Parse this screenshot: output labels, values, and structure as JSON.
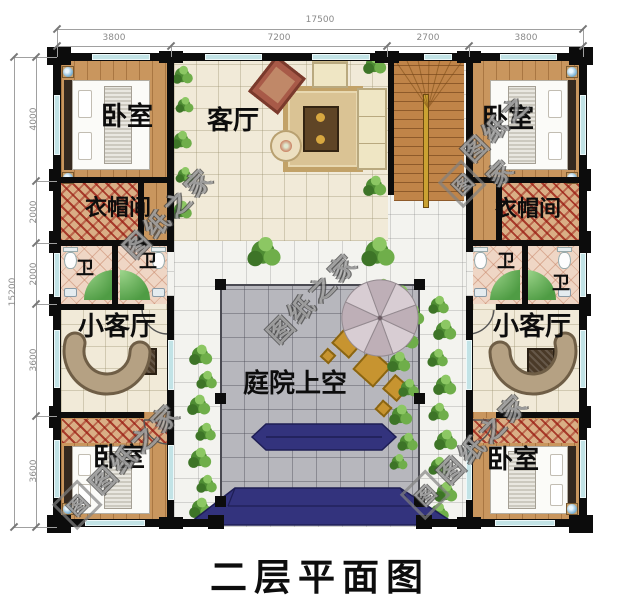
{
  "title": "二层平面图",
  "watermark": {
    "text": "图纸之家",
    "logo": "图"
  },
  "dims": {
    "top": {
      "total": "17500",
      "segs": [
        "3800",
        "7200",
        "2700",
        "3800"
      ]
    },
    "left": {
      "total": "15200",
      "segs": [
        "4000",
        "2000",
        "2000",
        "3600",
        "3600"
      ]
    }
  },
  "rooms": {
    "bedroom_tl": {
      "label": "卧室"
    },
    "bedroom_tr": {
      "label": "卧室"
    },
    "bedroom_bl": {
      "label": "卧室"
    },
    "bedroom_br": {
      "label": "卧室"
    },
    "living_room": {
      "label": "客厅"
    },
    "cloak_left": {
      "label": "衣帽间"
    },
    "cloak_right": {
      "label": "衣帽间"
    },
    "bath_left_1": {
      "label": "卫"
    },
    "bath_left_2": {
      "label": "卫"
    },
    "bath_right_1": {
      "label": "卫"
    },
    "bath_right_2": {
      "label": "卫"
    },
    "lounge_left": {
      "label": "小客厅"
    },
    "lounge_right": {
      "label": "小客厅"
    },
    "courtyard": {
      "label": "庭院上空"
    }
  },
  "colors": {
    "wall": "#0c0c0c",
    "window": "#c2e3e6",
    "wood_floor": "#c9965e",
    "cream_tile": "#f1ead8",
    "white_tile": "#f3f3ef",
    "courtyard_tile": "#b7b7bd",
    "awning_navy": "#33337d",
    "shower_green": "#4f9c44",
    "wardrobe_hatch_red": "#a03024",
    "dimension_gray": "#8a8a8a"
  }
}
